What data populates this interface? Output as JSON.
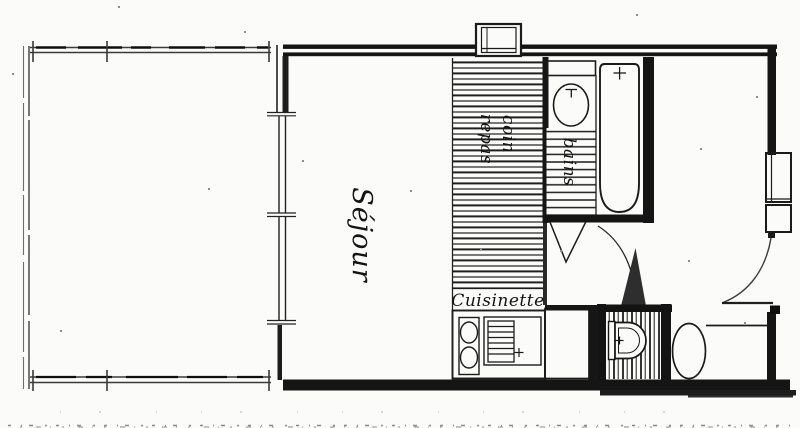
{
  "plan": {
    "title_hint": "apartment floor plan (scanned hand drawing)",
    "colors": {
      "ink": "#1a1a1a",
      "paper": "#fbfbf9",
      "hatch": "#222222"
    },
    "rooms": {
      "sejour": {
        "label": "Séjour"
      },
      "coin_repas": {
        "line1": "coin",
        "line2": "repas"
      },
      "bains": {
        "label": "bains"
      },
      "cuisinette": {
        "label": "Cuisinette"
      }
    }
  }
}
